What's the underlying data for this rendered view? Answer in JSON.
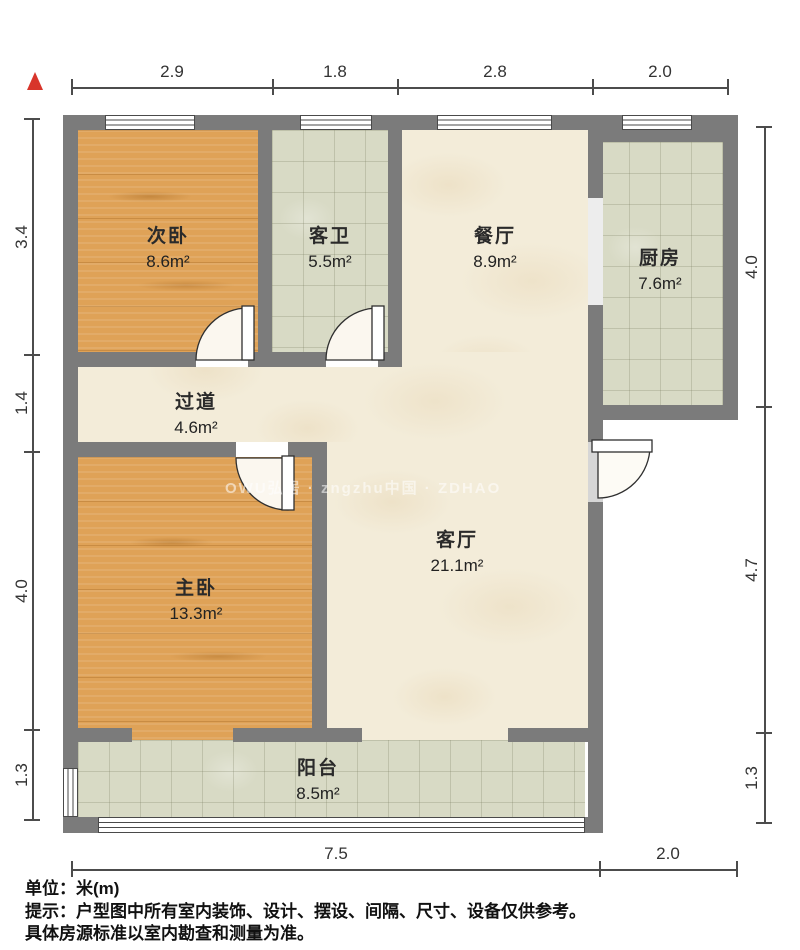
{
  "dimensions": {
    "top": [
      "2.9",
      "1.8",
      "2.8",
      "2.0"
    ],
    "left": [
      "3.4",
      "1.4",
      "4.0",
      "1.3"
    ],
    "right": [
      "4.0",
      "4.7",
      "1.3"
    ],
    "bottom": [
      "7.5",
      "2.0"
    ]
  },
  "rooms": [
    {
      "name": "次卧",
      "area": "8.6m²"
    },
    {
      "name": "客卫",
      "area": "5.5m²"
    },
    {
      "name": "餐厅",
      "area": "8.9m²"
    },
    {
      "name": "厨房",
      "area": "7.6m²"
    },
    {
      "name": "过道",
      "area": "4.6m²"
    },
    {
      "name": "主卧",
      "area": "13.3m²"
    },
    {
      "name": "客厅",
      "area": "21.1m²"
    },
    {
      "name": "阳台",
      "area": "8.5m²"
    }
  ],
  "watermark": "OWU弘居 · zngzhu中国 · ZDHAO",
  "footer": {
    "unit": "单位：米(m)",
    "tip": "提示：户型图中所有室内装饰、设计、摆设、间隔、尺寸、设备仅供参考。",
    "tip2": "具体房源标准以室内勘查和测量为准。"
  },
  "colors": {
    "wall": "#7b7b7b",
    "wood_floor": "#dfa257",
    "tile_floor": "#d8dac5",
    "marble_floor": "#f3ecd9",
    "north_arrow": "#d8352b"
  }
}
